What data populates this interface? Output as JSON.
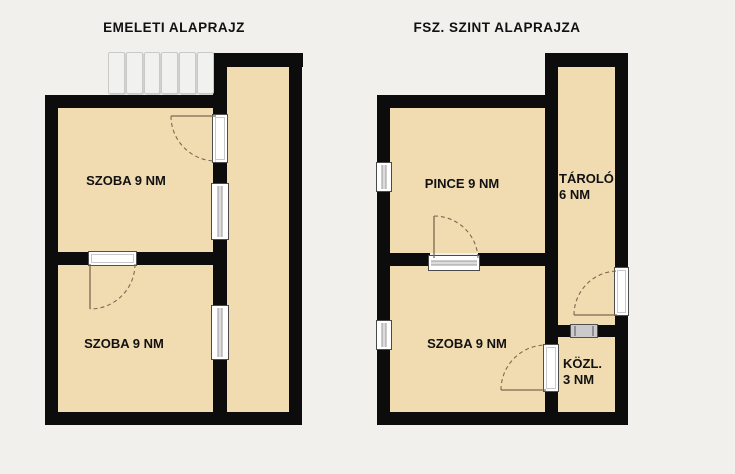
{
  "page": {
    "background": "#f2f0ec"
  },
  "colors": {
    "wall": "#0c0c0c",
    "room_fill": "#f1dbb0",
    "text": "#111111",
    "glass": "#dcdcdc",
    "stair_fill": "#f1f1ef",
    "vent_fill": "#cacaca",
    "door_arc": "#7b6a52"
  },
  "plans": [
    {
      "title": "EMELETI ALAPRAJZ",
      "rooms": [
        {
          "label": "SZOBA 9 NM"
        },
        {
          "label": "SZOBA 9 NM"
        }
      ],
      "features": [
        "staircase",
        "corridor"
      ]
    },
    {
      "title": "FSZ. SZINT ALAPRAJZA",
      "rooms": [
        {
          "label": "PINCE 9 NM"
        },
        {
          "label": "TÁROLÓ",
          "sublabel": "6 NM"
        },
        {
          "label": "SZOBA 9 NM"
        },
        {
          "label": "KÖZL.",
          "sublabel": "3 NM"
        }
      ]
    }
  ]
}
